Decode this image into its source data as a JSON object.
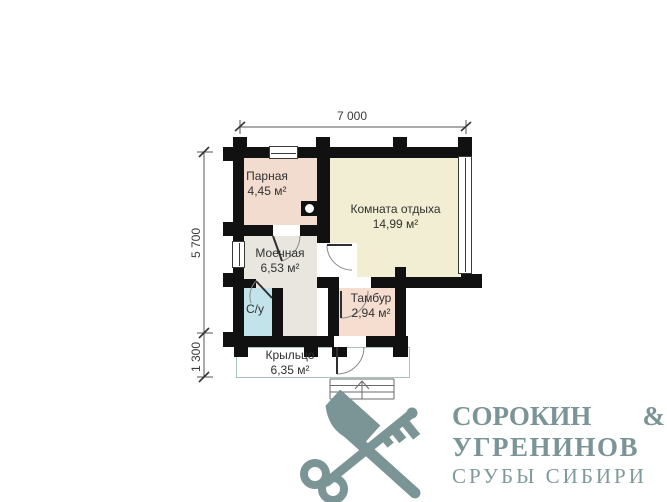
{
  "dimensions": {
    "top_width": "7 000",
    "side_height": "5 700",
    "porch_depth": "1 300"
  },
  "rooms": [
    {
      "name": "Парная",
      "area": "4,45 м²"
    },
    {
      "name": "Комната отдыха",
      "area": "14,99 м²"
    },
    {
      "name": "Моечная",
      "area": "6,53 м²"
    },
    {
      "name": "С/у"
    },
    {
      "name": "Тамбур",
      "area": "2,94 м²"
    },
    {
      "name": "Крыльцо",
      "area": "6,35 м²"
    }
  ],
  "colors": {
    "walls": "#111111",
    "parnaya_floor": "#f2dcd0",
    "komnata_otdyha_floor": "#f1eed3",
    "moechnaya_floor": "#e9e6df",
    "su_floor": "#c3e3ea",
    "tambur_floor": "#f5ddd0",
    "porch_outline": "#a9c3c1",
    "brand": "#7b9496"
  },
  "brand": {
    "name_line1_left": "СОРОКИН",
    "name_line1_right": "&",
    "name_line2": "УГРЕНИНОВ",
    "tagline": "СРУБЫ СИБИРИ",
    "emblem": "axe-and-key-crossed"
  }
}
